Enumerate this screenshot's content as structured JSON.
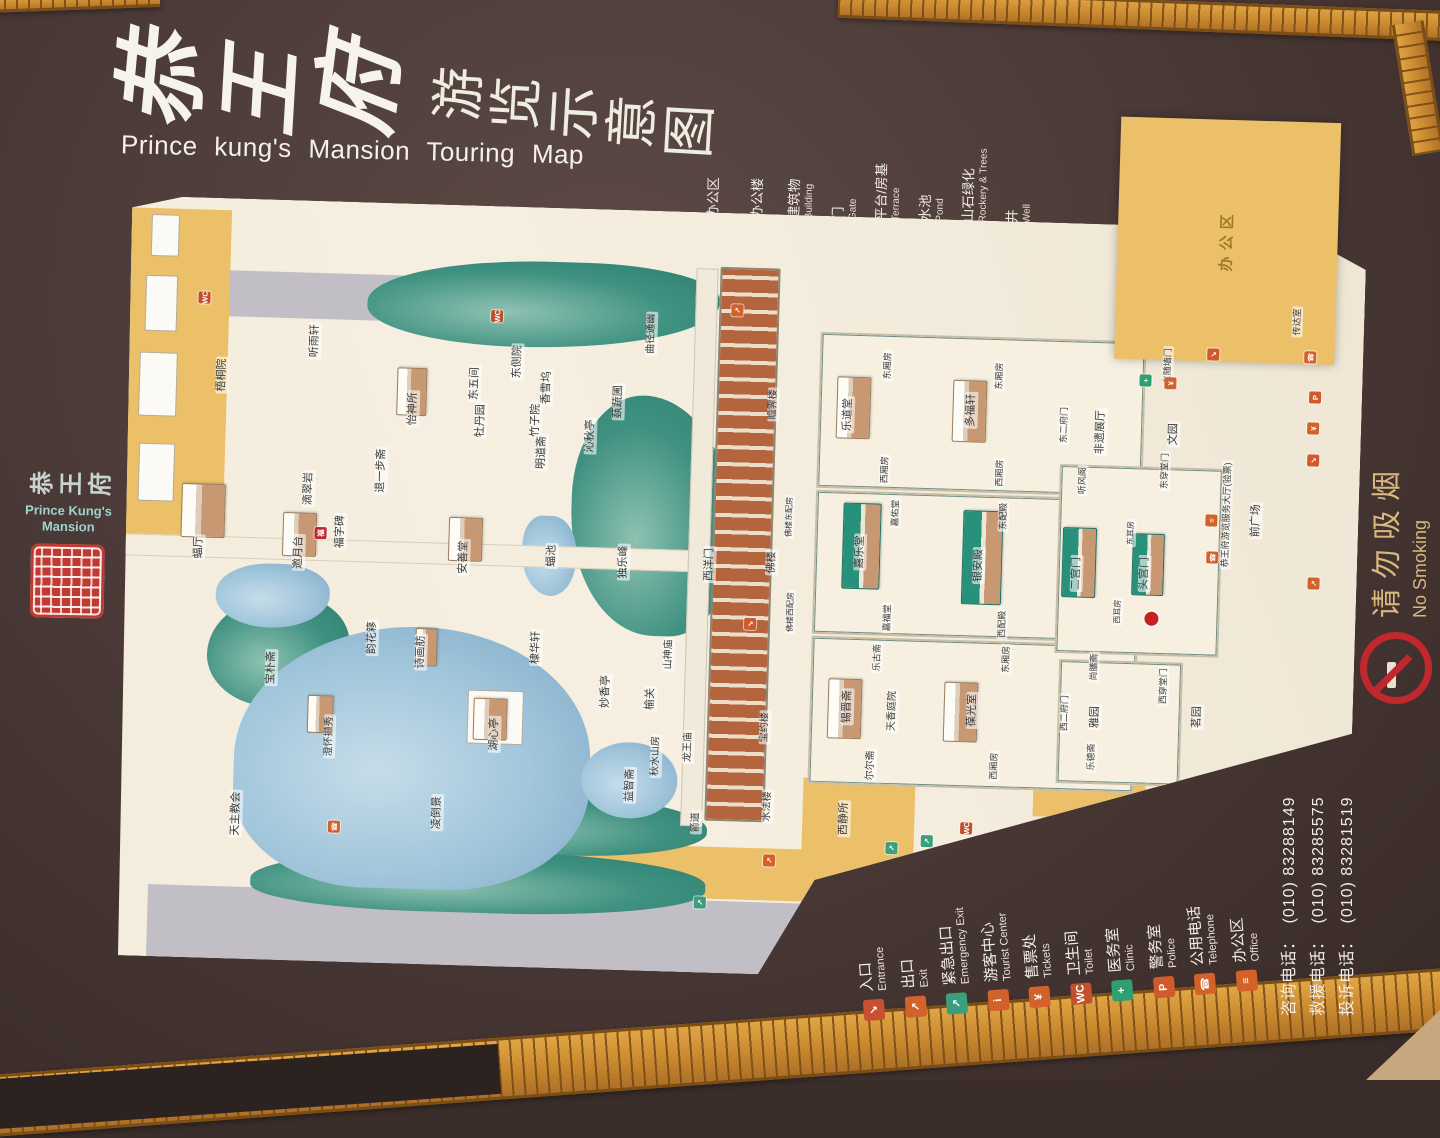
{
  "title": {
    "calligraphy": "恭王府",
    "subtitle": "游览示意图",
    "english": "Prince kung's  Mansion  Touring Map"
  },
  "side_logo": {
    "chars": "恭王府",
    "english_line1": "Prince Kung's",
    "english_line2": "Mansion",
    "seal_color": "#c03a31"
  },
  "no_smoking": {
    "zh": "请勿吸烟",
    "en": "No Smoking"
  },
  "map_legend": {
    "items": [
      {
        "zh": "办公区",
        "en": "",
        "swatch": "#ecc069"
      },
      {
        "zh": "办公楼",
        "en": "",
        "swatch": "#a9b3c6"
      },
      {
        "zh": "建筑物",
        "en": "Building",
        "swatch": "#f6f3ec"
      },
      {
        "zh": "门",
        "en": "Gate",
        "swatch": "#f6f3ec",
        "small": true
      },
      {
        "zh": "平台/房基",
        "en": "Terrace",
        "swatch": "#f0ece2"
      },
      {
        "zh": "水池",
        "en": "Pond",
        "swatch": "grad-blue"
      },
      {
        "zh": "山石绿化",
        "en": "Rockery & Trees",
        "swatch": "grad-green"
      },
      {
        "zh": "井",
        "en": "Well",
        "swatch": "#f6f3ec",
        "small": true
      }
    ]
  },
  "facility_legend": {
    "items": [
      {
        "zh": "入口",
        "en": "Entrance",
        "color": "#c8502e",
        "glyph": "↘"
      },
      {
        "zh": "出口",
        "en": "Exit",
        "color": "#d2622a",
        "glyph": "↗"
      },
      {
        "zh": "紧急出口",
        "en": "Emergency Exit",
        "color": "#3a9f7d",
        "glyph": "↗"
      },
      {
        "zh": "游客中心",
        "en": "Tourist Center",
        "color": "#d2622a",
        "glyph": "i"
      },
      {
        "zh": "售票处",
        "en": "Tickets",
        "color": "#d2622a",
        "glyph": "¥"
      },
      {
        "zh": "卫生间",
        "en": "Toilet",
        "color": "#c2502c",
        "glyph": "WC"
      },
      {
        "zh": "医务室",
        "en": "Clinic",
        "color": "#2f9e72",
        "glyph": "+"
      },
      {
        "zh": "警务室",
        "en": "Police",
        "color": "#cf5a2b",
        "glyph": "P"
      },
      {
        "zh": "公用电话",
        "en": "Telephone",
        "color": "#d2622a",
        "glyph": "☎"
      },
      {
        "zh": "办公区",
        "en": "Office",
        "color": "#d2622a",
        "glyph": "≡"
      }
    ]
  },
  "phones": [
    {
      "label": "咨询电话：",
      "number": "(010) 83288149"
    },
    {
      "label": "救援电话：",
      "number": "(010) 83285575"
    },
    {
      "label": "投诉电话：",
      "number": "(010) 83281519"
    }
  ],
  "map": {
    "icon_colors": {
      "entrance": "#cf5a2b",
      "exit": "#d2622a",
      "emergency": "#3a9f7d",
      "toilet": "#c2502c",
      "clinic": "#2f9e72",
      "telephone": "#d2622a",
      "tickets": "#d2622a",
      "police": "#cf5a2b",
      "office": "#d2622a",
      "fu": "#c1272d"
    },
    "icon_glyphs": {
      "entrance": "↘",
      "exit": "↗",
      "emergency": "↗",
      "toilet": "WC",
      "clinic": "+",
      "telephone": "☎",
      "tickets": "¥",
      "police": "P",
      "office": "≡",
      "fu": "福"
    },
    "labels": [
      {
        "t": "梧桐院",
        "u": 583,
        "v": 95
      },
      {
        "t": "蝠厅",
        "u": 410,
        "v": 77
      },
      {
        "t": "宝朴斋",
        "u": 292,
        "v": 153
      },
      {
        "t": "邀月台",
        "u": 408,
        "v": 177
      },
      {
        "t": "滴翠岩",
        "u": 472,
        "v": 185
      },
      {
        "t": "澄怀撷秀",
        "u": 225,
        "v": 213,
        "s": 10
      },
      {
        "t": "福字碑",
        "u": 430,
        "v": 218
      },
      {
        "t": "韵花簃",
        "u": 325,
        "v": 253
      },
      {
        "t": "退一步斋",
        "u": 492,
        "v": 257
      },
      {
        "t": "怡神所",
        "u": 555,
        "v": 287
      },
      {
        "t": "诗画舫",
        "u": 312,
        "v": 302
      },
      {
        "t": "凌倒景",
        "u": 152,
        "v": 323
      },
      {
        "t": "听雨轩",
        "u": 620,
        "v": 187
      },
      {
        "t": "安善堂",
        "u": 408,
        "v": 342
      },
      {
        "t": "东五间",
        "u": 582,
        "v": 348
      },
      {
        "t": "牡丹园",
        "u": 545,
        "v": 355
      },
      {
        "t": "湖心亭",
        "u": 232,
        "v": 378
      },
      {
        "t": "东侧院",
        "u": 605,
        "v": 390
      },
      {
        "t": "竹子院",
        "u": 547,
        "v": 410
      },
      {
        "t": "香雪坞",
        "u": 580,
        "v": 420
      },
      {
        "t": "明道斋",
        "u": 515,
        "v": 417
      },
      {
        "t": "棣华轩",
        "u": 320,
        "v": 417
      },
      {
        "t": "蝠池",
        "u": 412,
        "v": 430
      },
      {
        "t": "沁秋亭",
        "u": 533,
        "v": 465
      },
      {
        "t": "妙香亭",
        "u": 278,
        "v": 488
      },
      {
        "t": "蓺蔬圃",
        "u": 568,
        "v": 492
      },
      {
        "t": "独乐峰",
        "u": 408,
        "v": 502
      },
      {
        "t": "益智斋",
        "u": 185,
        "v": 515
      },
      {
        "t": "曲径通幽",
        "u": 637,
        "v": 523,
        "s": 10
      },
      {
        "t": "榆关",
        "u": 272,
        "v": 533
      },
      {
        "t": "秋水山房",
        "u": 215,
        "v": 540,
        "s": 10
      },
      {
        "t": "山神庙",
        "u": 317,
        "v": 550,
        "s": 10
      },
      {
        "t": "龙王庙",
        "u": 225,
        "v": 572,
        "s": 10
      },
      {
        "t": "西洋门",
        "u": 408,
        "v": 588
      },
      {
        "t": "天主教会",
        "u": 145,
        "v": 122
      },
      {
        "t": "箭道",
        "u": 150,
        "v": 582,
        "s": 10
      },
      {
        "t": "瞻霁楼",
        "u": 570,
        "v": 647,
        "s": 10
      },
      {
        "t": "佛楼",
        "u": 412,
        "v": 650
      },
      {
        "t": "宝约楼",
        "u": 247,
        "v": 648,
        "s": 10
      },
      {
        "t": "水法楼",
        "u": 168,
        "v": 653,
        "s": 10
      },
      {
        "t": "佛楼东配房",
        "u": 458,
        "v": 666,
        "s": 8
      },
      {
        "t": "佛楼西配房",
        "u": 363,
        "v": 670,
        "s": 8
      },
      {
        "t": "乐道堂",
        "u": 562,
        "v": 722
      },
      {
        "t": "东厢房",
        "u": 612,
        "v": 760,
        "s": 9
      },
      {
        "t": "西厢房",
        "u": 508,
        "v": 760,
        "s": 9
      },
      {
        "t": "嘉佑堂",
        "u": 465,
        "v": 772,
        "s": 9
      },
      {
        "t": "嘉乐堂",
        "u": 425,
        "v": 738
      },
      {
        "t": "嘉福堂",
        "u": 360,
        "v": 767,
        "s": 9
      },
      {
        "t": "多福轩",
        "u": 570,
        "v": 845
      },
      {
        "t": "东厢房",
        "u": 605,
        "v": 872,
        "s": 9
      },
      {
        "t": "西厢房",
        "u": 508,
        "v": 875,
        "s": 9
      },
      {
        "t": "东配殿",
        "u": 465,
        "v": 880,
        "s": 9
      },
      {
        "t": "银安殿",
        "u": 415,
        "v": 857
      },
      {
        "t": "西配殿",
        "u": 357,
        "v": 882,
        "s": 9
      },
      {
        "t": "乐古斋",
        "u": 320,
        "v": 758,
        "s": 9
      },
      {
        "t": "锡晋斋",
        "u": 270,
        "v": 730
      },
      {
        "t": "天香庭院",
        "u": 267,
        "v": 775,
        "s": 10
      },
      {
        "t": "尔尔斋",
        "u": 212,
        "v": 755,
        "s": 10
      },
      {
        "t": "西静所",
        "u": 158,
        "v": 730
      },
      {
        "t": "葆光室",
        "u": 270,
        "v": 855
      },
      {
        "t": "东厢房",
        "u": 322,
        "v": 887,
        "s": 9
      },
      {
        "t": "西厢房",
        "u": 215,
        "v": 878,
        "s": 9
      },
      {
        "t": "尚膳斋",
        "u": 317,
        "v": 975,
        "s": 9
      },
      {
        "t": "西二府门",
        "u": 270,
        "v": 947,
        "s": 9
      },
      {
        "t": "雅园",
        "u": 267,
        "v": 978
      },
      {
        "t": "乐德斋",
        "u": 227,
        "v": 975,
        "s": 9
      },
      {
        "t": "茗园",
        "u": 270,
        "v": 1080
      },
      {
        "t": "西穿堂门",
        "u": 300,
        "v": 1045,
        "s": 9
      },
      {
        "t": "二宫门",
        "u": 410,
        "v": 955
      },
      {
        "t": "头宫门",
        "u": 412,
        "v": 1023
      },
      {
        "t": "东耳房",
        "u": 452,
        "v": 1008,
        "s": 8
      },
      {
        "t": "西耳房",
        "u": 373,
        "v": 997,
        "s": 8
      },
      {
        "t": "听风阁",
        "u": 503,
        "v": 958,
        "s": 9
      },
      {
        "t": "东二府门",
        "u": 558,
        "v": 938,
        "s": 9
      },
      {
        "t": "非遗展厅",
        "u": 552,
        "v": 975
      },
      {
        "t": "文园",
        "u": 552,
        "v": 1048
      },
      {
        "t": "东穿堂门",
        "u": 515,
        "v": 1040,
        "s": 9
      },
      {
        "t": "东随墙门",
        "u": 620,
        "v": 1040,
        "s": 9
      },
      {
        "t": "恭王府游览服务大厅(验票)",
        "u": 473,
        "v": 1103,
        "s": 9
      },
      {
        "t": "前广场",
        "u": 468,
        "v": 1133
      },
      {
        "t": "传达室",
        "u": 668,
        "v": 1168,
        "s": 9
      },
      {
        "t": "办公区",
        "u": 748,
        "v": 1096,
        "s": 15,
        "cls": "area"
      }
    ],
    "icons": [
      {
        "t": "toilet",
        "u": 660,
        "v": 75
      },
      {
        "t": "toilet",
        "u": 650,
        "v": 368
      },
      {
        "t": "exit",
        "u": 663,
        "v": 608
      },
      {
        "t": "entrance",
        "u": 350,
        "v": 630
      },
      {
        "t": "emergency",
        "u": 70,
        "v": 588
      },
      {
        "t": "exit",
        "u": 114,
        "v": 656
      },
      {
        "t": "emergency",
        "u": 130,
        "v": 778
      },
      {
        "t": "emergency",
        "u": 138,
        "v": 813
      },
      {
        "t": "toilet",
        "u": 152,
        "v": 852
      },
      {
        "t": "telephone",
        "u": 135,
        "v": 220
      },
      {
        "t": "clinic",
        "u": 605,
        "v": 1018
      },
      {
        "t": "tickets",
        "u": 603,
        "v": 1043
      },
      {
        "t": "entrance",
        "u": 633,
        "v": 1085
      },
      {
        "t": "telephone",
        "u": 633,
        "v": 1182
      },
      {
        "t": "police",
        "u": 593,
        "v": 1188
      },
      {
        "t": "tickets",
        "u": 562,
        "v": 1187
      },
      {
        "t": "entrance",
        "u": 530,
        "v": 1188
      },
      {
        "t": "office",
        "u": 467,
        "v": 1088
      },
      {
        "t": "telephone",
        "u": 430,
        "v": 1090
      },
      {
        "t": "exit",
        "u": 407,
        "v": 1192
      },
      {
        "t": "fu",
        "u": 428,
        "v": 198
      }
    ]
  }
}
